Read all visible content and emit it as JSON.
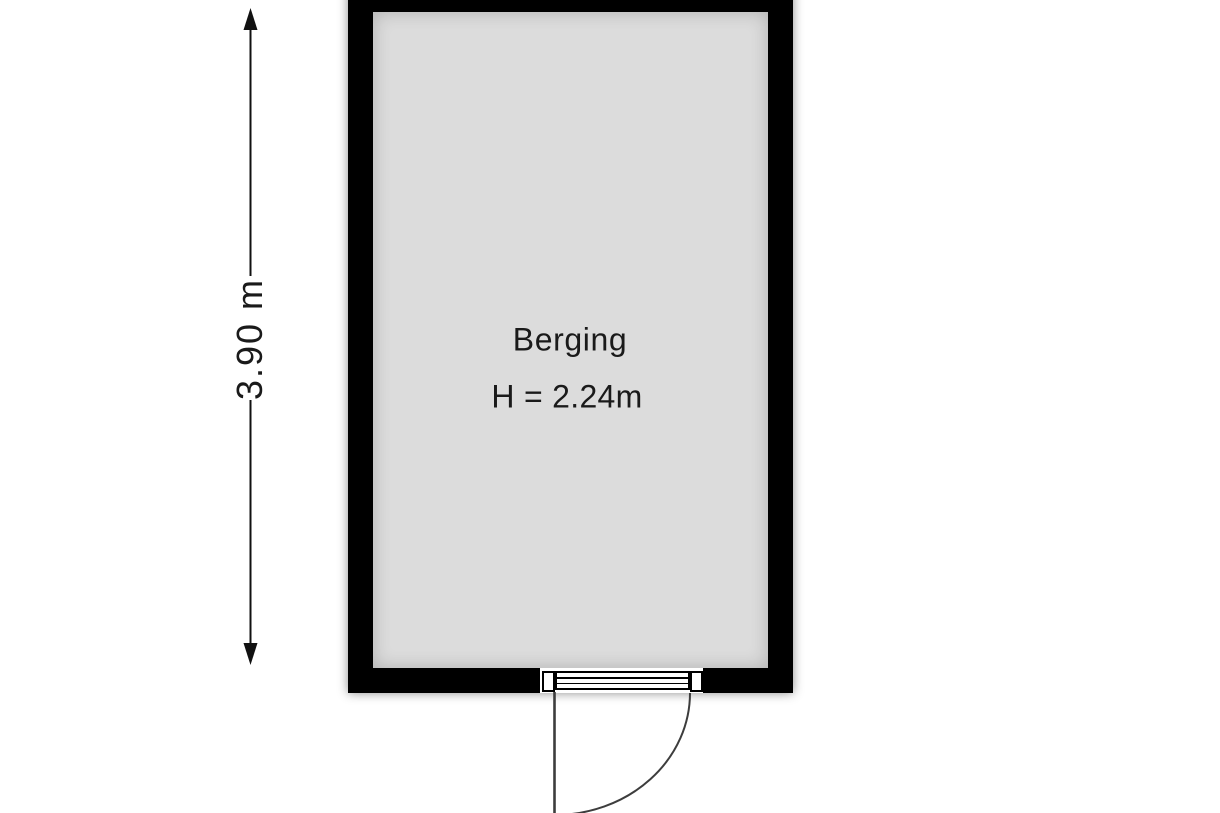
{
  "floorplan": {
    "room": {
      "name": "Berging",
      "height_label": "H = 2.24m"
    },
    "dimensions": {
      "vertical_label": "3.90 m"
    },
    "colors": {
      "wall": "#000000",
      "floor": "#dcdcdc",
      "background": "#ffffff",
      "line": "#3d3d3d",
      "dimension": "#111111",
      "text": "#1a1a1a"
    }
  }
}
